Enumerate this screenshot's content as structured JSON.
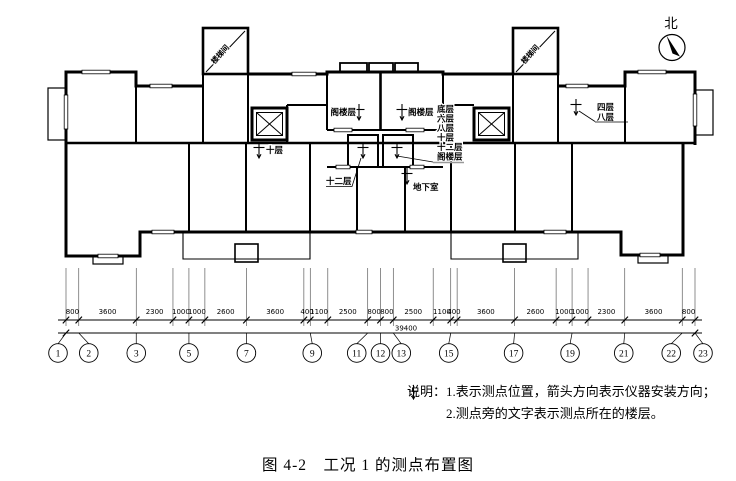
{
  "plan": {
    "north_label": "北",
    "staircase_label": "楼梯间",
    "points": {
      "ten": "十层",
      "attic_left": "阁楼层",
      "twelve": "十二层",
      "attic_right": "阁楼层",
      "basement": "地下室"
    },
    "stack_left": [
      "底层",
      "六层",
      "八层",
      "十层",
      "十二层",
      "阁楼层"
    ],
    "stack_right": [
      "四层",
      "八层"
    ]
  },
  "dimensions": {
    "segments": [
      800,
      3600,
      2300,
      1000,
      1000,
      2600,
      3600,
      400,
      1100,
      2500,
      800,
      800,
      2500,
      1100,
      400,
      3600,
      2600,
      1000,
      1000,
      2300,
      3600,
      800
    ],
    "total": "39400"
  },
  "axes": [
    {
      "n": "1",
      "i": 0,
      "dx": -8
    },
    {
      "n": "2",
      "i": 1,
      "dx": 10
    },
    {
      "n": "3",
      "i": 2,
      "dx": 0
    },
    {
      "n": "5",
      "i": 4,
      "dx": 0
    },
    {
      "n": "7",
      "i": 6,
      "dx": 0
    },
    {
      "n": "9",
      "i": 8,
      "dx": 2
    },
    {
      "n": "11",
      "i": 10,
      "dx": -11
    },
    {
      "n": "12",
      "i": 11,
      "dx": 0
    },
    {
      "n": "13",
      "i": 12,
      "dx": 8
    },
    {
      "n": "15",
      "i": 14,
      "dx": -2
    },
    {
      "n": "17",
      "i": 16,
      "dx": -1
    },
    {
      "n": "19",
      "i": 18,
      "dx": -2
    },
    {
      "n": "21",
      "i": 20,
      "dx": -1
    },
    {
      "n": "22",
      "i": 21,
      "dx": -11
    },
    {
      "n": "23",
      "i": 22,
      "dx": 8
    }
  ],
  "notes": {
    "title": "说明：",
    "item1_num": "1.",
    "item1": "表示测点位置，箭头方向表示仪器安装方向；",
    "item2": "2.测点旁的文字表示测点所在的楼层。"
  },
  "caption": "图 4-2　工况 1 的测点布置图",
  "colors": {
    "line": "#000000",
    "leader_gray": "#999999",
    "background": "#ffffff"
  }
}
